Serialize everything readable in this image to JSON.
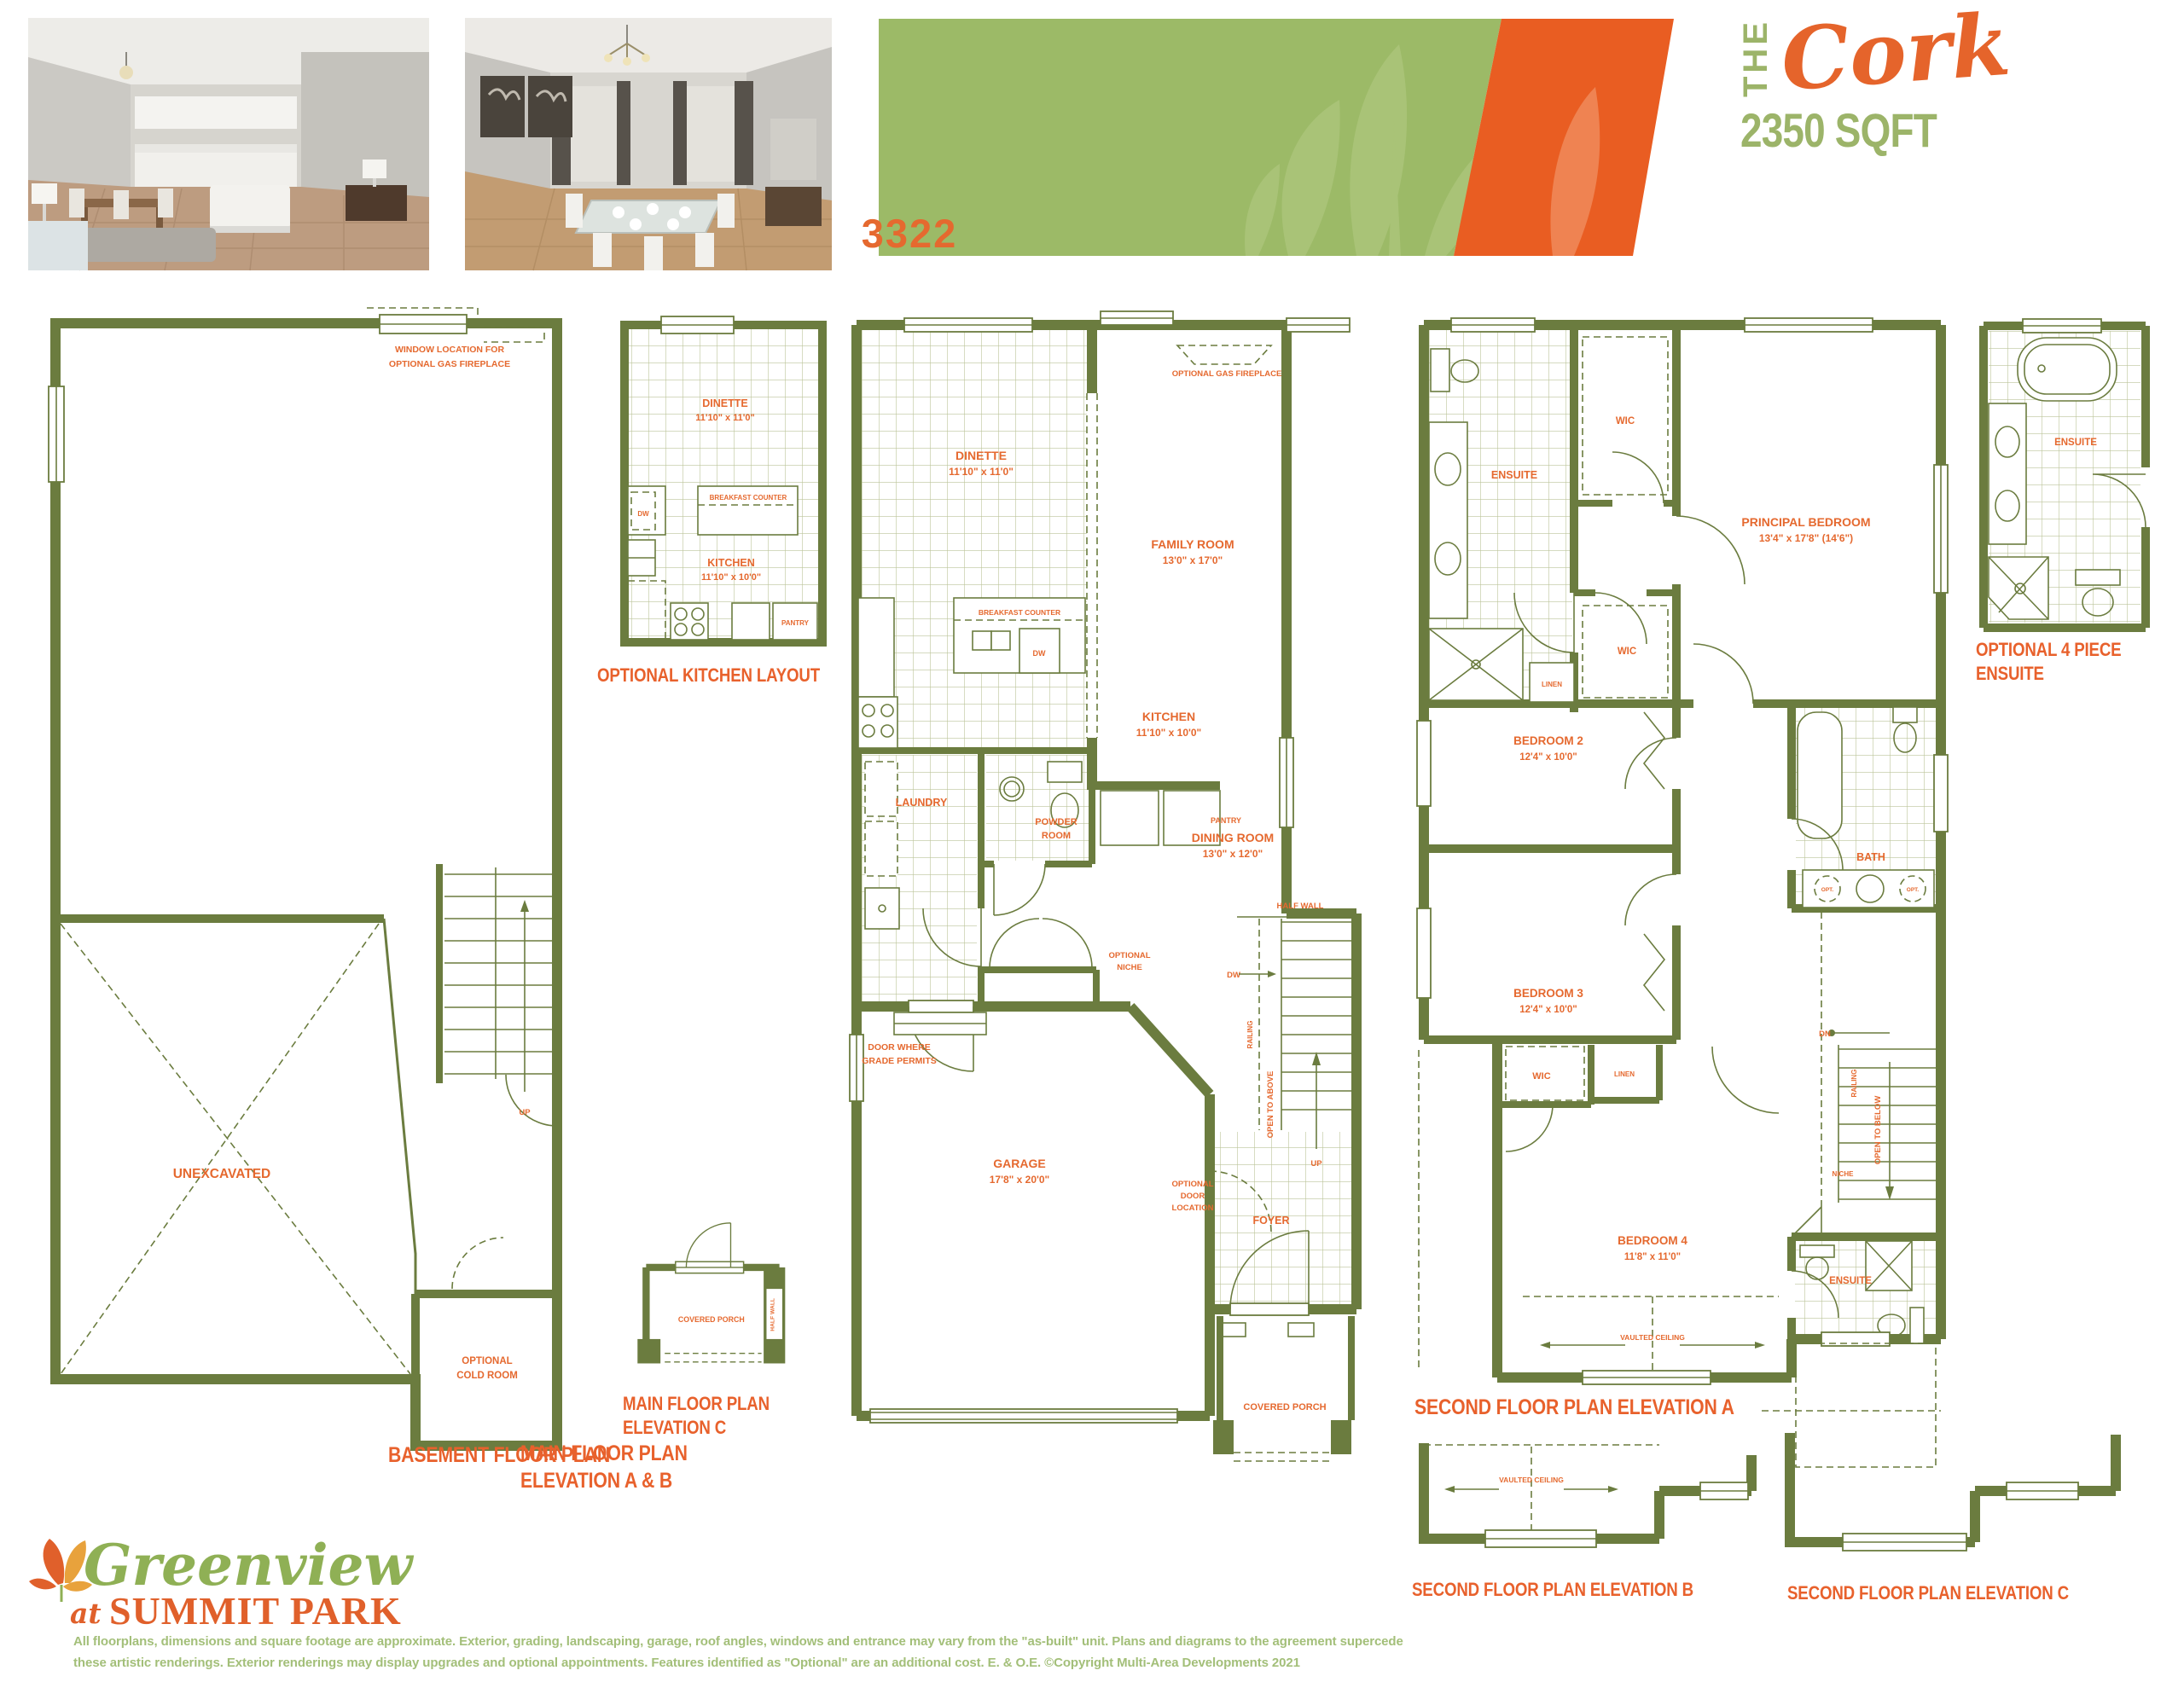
{
  "header": {
    "model_number": "3322",
    "title_prefix": "THE",
    "title_name": "Cork",
    "title_sqft": "2350 SQFT",
    "photos": [
      {
        "name": "interior photo - kitchen and dinette"
      },
      {
        "name": "interior photo - dining room"
      }
    ]
  },
  "colors": {
    "wall_green": "#6B7C3F",
    "label_orange": "#E5692F",
    "banner_green": "#9CBA67",
    "banner_orange": "#E95D22",
    "sqft_green": "#9CB469"
  },
  "captions": {
    "basement": "BASEMENT FLOOR PLAN",
    "optional_kitchen": "OPTIONAL KITCHEN LAYOUT",
    "main_ab_1": "MAIN FLOOR PLAN",
    "main_ab_2": "ELEVATION A & B",
    "main_c_1": "MAIN FLOOR PLAN",
    "main_c_2": "ELEVATION C",
    "second_a": "SECOND FLOOR PLAN ELEVATION A",
    "optional_ensuite_1": "OPTIONAL 4 PIECE",
    "optional_ensuite_2": "ENSUITE",
    "second_b": "SECOND FLOOR PLAN ELEVATION B",
    "second_c": "SECOND FLOOR PLAN ELEVATION C"
  },
  "basement": {
    "window_note_1": "WINDOW LOCATION FOR",
    "window_note_2": "OPTIONAL GAS FIREPLACE",
    "unexcavated": "UNEXCAVATED",
    "up": "UP",
    "cold_room_1": "OPTIONAL",
    "cold_room_2": "COLD ROOM"
  },
  "optional_kitchen": {
    "dinette": "DINETTE",
    "dinette_dim": "11'10\" x 11'0\"",
    "breakfast_counter": "BREAKFAST COUNTER",
    "dw": "DW",
    "kitchen": "KITCHEN",
    "kitchen_dim": "11'10\" x 10'0\"",
    "pantry": "PANTRY"
  },
  "main_floor": {
    "optional_gas_fireplace": "OPTIONAL GAS FIREPLACE",
    "dinette": "DINETTE",
    "dinette_dim": "11'10\" x 11'0\"",
    "family_room": "FAMILY ROOM",
    "family_room_dim": "13'0\" x 17'0\"",
    "breakfast_counter": "BREAKFAST COUNTER",
    "dw": "DW",
    "kitchen": "KITCHEN",
    "kitchen_dim": "11'10\" x 10'0\"",
    "pantry": "PANTRY",
    "dining_room": "DINING ROOM",
    "dining_room_dim": "13'0\" x 12'0\"",
    "laundry": "LAUNDRY",
    "powder_1": "POWDER",
    "powder_2": "ROOM",
    "door_grade_1": "DOOR WHERE",
    "door_grade_2": "GRADE PERMITS",
    "optional_niche_1": "OPTIONAL",
    "optional_niche_2": "NICHE",
    "half_wall": "HALF WALL",
    "dw_stairs": "DW",
    "railing": "RAILING",
    "open_to_above": "OPEN TO ABOVE",
    "up": "UP",
    "garage": "GARAGE",
    "garage_dim": "17'8\" x 20'0\"",
    "optional_door_1": "OPTIONAL",
    "optional_door_2": "DOOR",
    "optional_door_3": "LOCATION",
    "foyer": "FOYER",
    "covered_porch": "COVERED PORCH"
  },
  "main_c": {
    "covered_porch": "COVERED PORCH",
    "half_wall": "HALF WALL"
  },
  "second_floor": {
    "ensuite": "ENSUITE",
    "wic_top": "WIC",
    "principal": "PRINCIPAL BEDROOM",
    "principal_dim": "13'4\" x 17'8\" (14'6\")",
    "wic_mid": "WIC",
    "linen_top": "LINEN",
    "bedroom2": "BEDROOM 2",
    "bedroom2_dim": "12'4\" x 10'0\"",
    "bath": "BATH",
    "opt_left": "OPT.",
    "opt_right": "OPT.",
    "bedroom3": "BEDROOM 3",
    "bedroom3_dim": "12'4\" x 10'0\"",
    "dn": "DN",
    "wic_bottom": "WIC",
    "linen_bottom": "LINEN",
    "railing": "RAILING",
    "open_to_below": "OPEN TO BELOW",
    "niche": "NICHE",
    "bedroom4": "BEDROOM 4",
    "bedroom4_dim": "11'8\" x 11'0\"",
    "vaulted_ceiling": "VAULTED CEILING",
    "ensuite2": "ENSUITE"
  },
  "optional_ensuite": {
    "ensuite": "ENSUITE"
  },
  "second_b": {
    "vaulted_ceiling": "VAULTED CEILING"
  },
  "footer": {
    "logo_script": "Greenview",
    "logo_at": "at",
    "logo_park": "SUMMIT PARK",
    "disclaimer_1": "All floorplans, dimensions and square footage are approximate. Exterior, grading, landscaping, garage, roof angles, windows and entrance may vary from the \"as-built\" unit. Plans and diagrams to the agreement supercede",
    "disclaimer_2": "these artistic renderings. Exterior renderings may display upgrades and optional appointments. Features identified as \"Optional\" are an additional cost. E. & O.E. ©Copyright Multi-Area Developments 2021"
  }
}
